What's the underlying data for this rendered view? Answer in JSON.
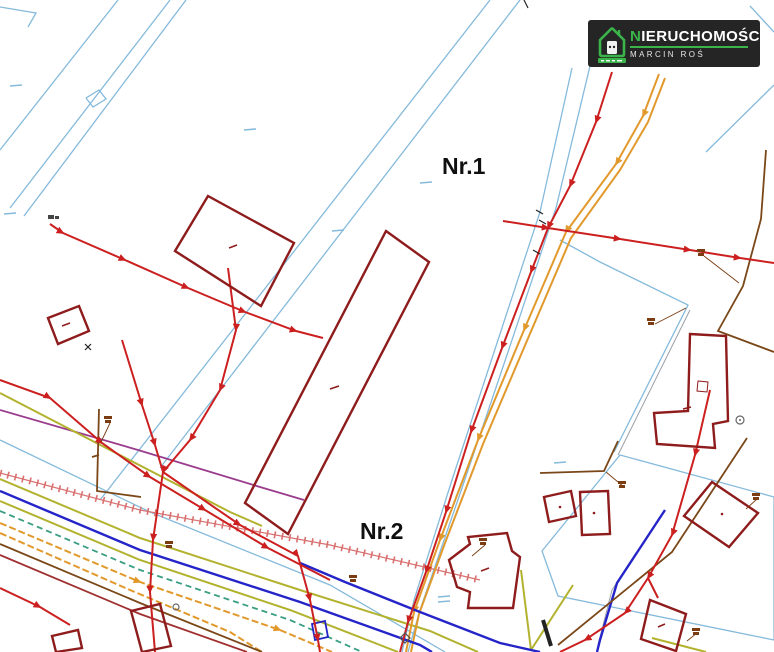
{
  "page": {
    "background": "#ffffff"
  },
  "logo": {
    "brand": "NIERUCHOMOŚCI",
    "brand_first_letter": "N",
    "brand_rest": "IERUCHOMOŚCI",
    "subtitle": "MARCIN ROŚ",
    "background": "#252525",
    "accent_green": "#3bb44a",
    "text_color": "#ffffff"
  },
  "map": {
    "area_labels": [
      {
        "text": "Nr.1"
      },
      {
        "text": "Nr.2"
      }
    ],
    "palette": {
      "parcel_boundary_blue": "#85badb",
      "utility_line_red": "#cc2020",
      "building_outline_dark_red": "#8e1c1c",
      "utility_line_orange": "#e2992c",
      "utility_line_olive": "#b2b22e",
      "utility_line_blue": "#2424c8",
      "utility_line_teal": "#3a9e82",
      "boundary_brown": "#7a4718",
      "utility_line_purple": "#9a3c8e",
      "embankment_hatch_pink": "#d97070",
      "survey_label_brown": "#7a3c10"
    }
  }
}
